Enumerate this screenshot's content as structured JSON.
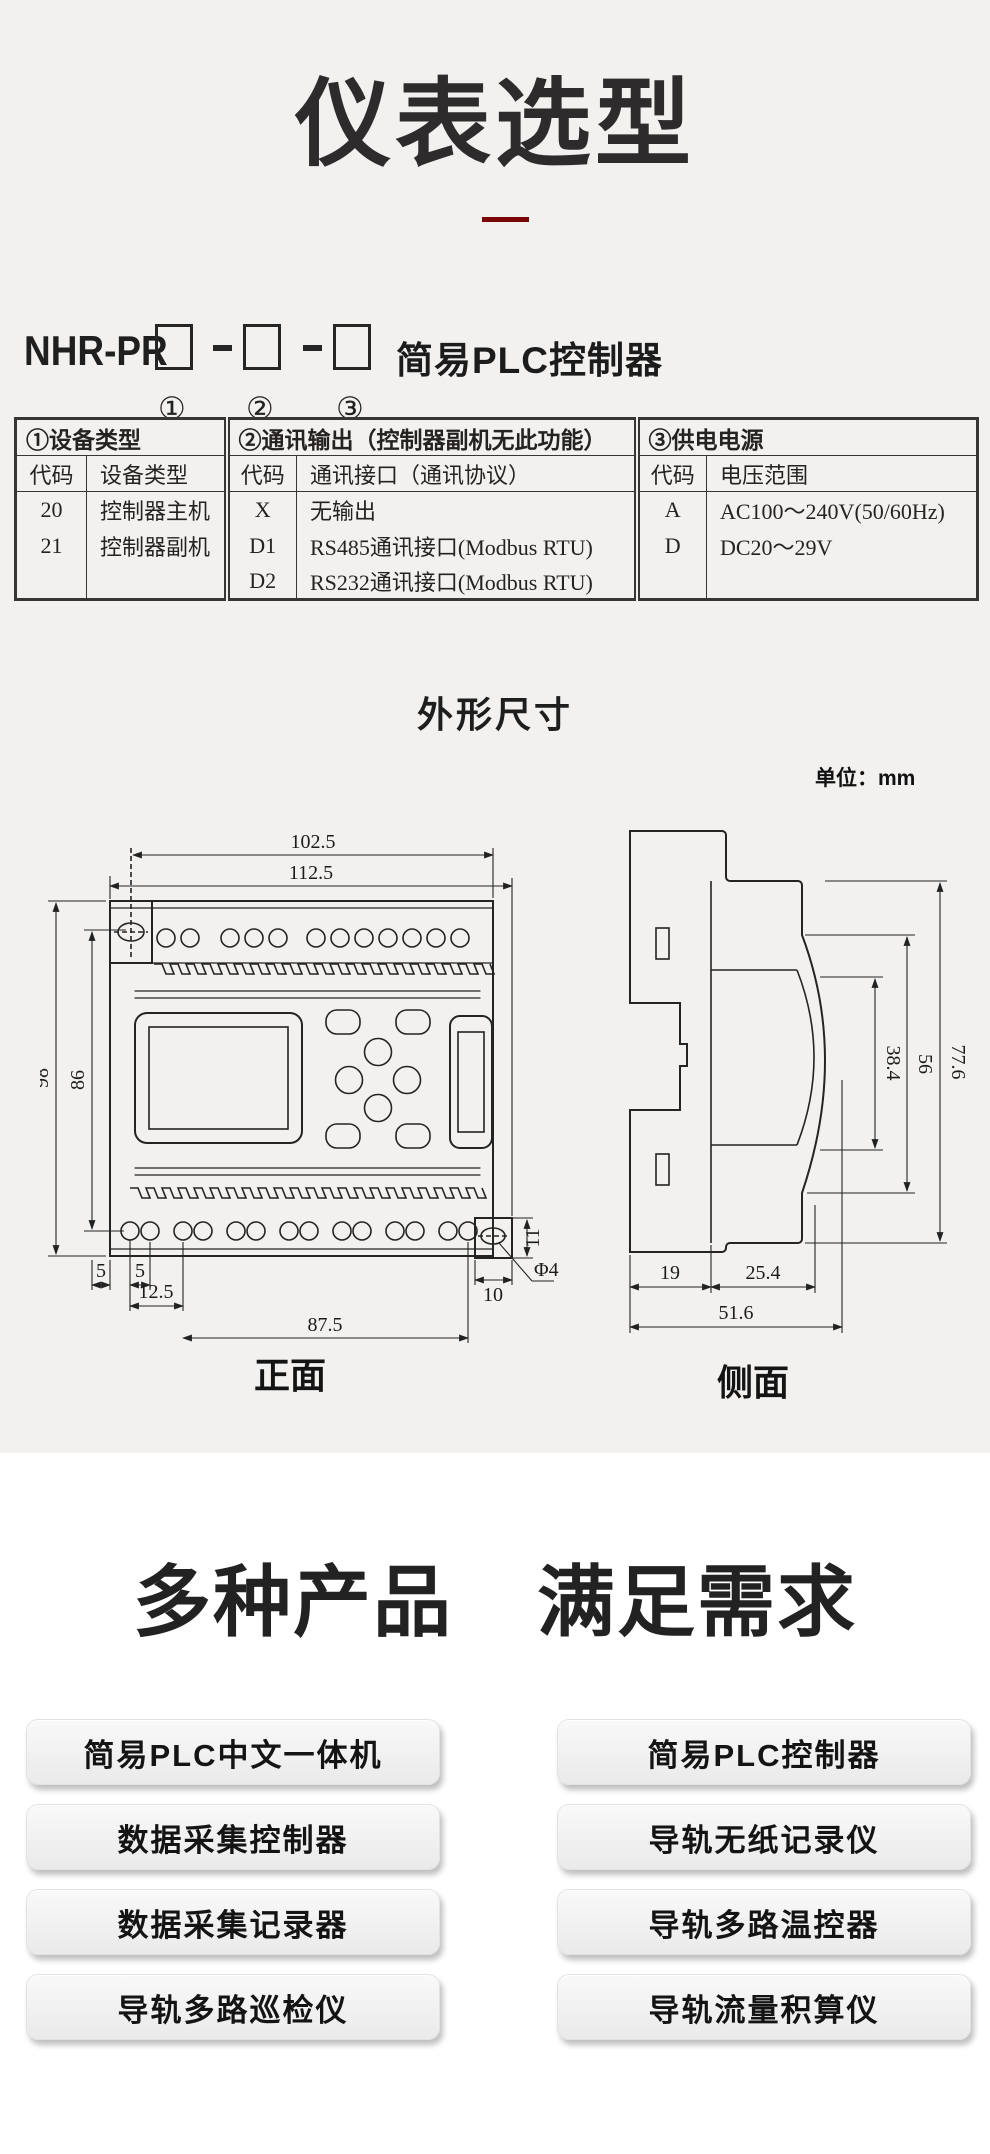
{
  "title": "仪表选型",
  "model": {
    "prefix": "NHR-PR",
    "suffix": "简易PLC控制器",
    "marks": [
      "①",
      "②",
      "③"
    ]
  },
  "table": {
    "sections": [
      "①设备类型",
      "②通讯输出（控制器副机无此功能）",
      "③供电电源"
    ],
    "columns": [
      "代码",
      "设备类型",
      "代码",
      "通讯接口（通讯协议）",
      "代码",
      "电压范围"
    ],
    "rows": [
      [
        "20",
        "控制器主机",
        "X",
        "无输出",
        "A",
        "AC100～240V(50/60Hz)"
      ],
      [
        "21",
        "控制器副机",
        "D1",
        "RS485通讯接口(Modbus RTU)",
        "D",
        "DC20～29V"
      ],
      [
        "",
        "",
        "D2",
        "RS232通讯接口(Modbus RTU)",
        "",
        ""
      ]
    ]
  },
  "dims": {
    "heading": "外形尺寸",
    "unit": "单位：mm",
    "front": {
      "label": "正面",
      "w1": "102.5",
      "w2": "112.5",
      "h1": "98",
      "h2": "86",
      "g1": "5",
      "g2": "5",
      "g3": "12.5",
      "g4": "87.5",
      "e1": "11",
      "e2": "10",
      "hole": "Φ4"
    },
    "side": {
      "label": "侧面",
      "h1": "77.6",
      "h2": "56",
      "h3": "38.4",
      "d1": "19",
      "d2": "25.4",
      "d3": "51.6"
    }
  },
  "products": {
    "heading": [
      "多种产品",
      "满足需求"
    ],
    "items": [
      "简易PLC中文一体机",
      "简易PLC控制器",
      "数据采集控制器",
      "导轨无纸记录仪",
      "数据采集记录器",
      "导轨多路温控器",
      "导轨多路巡检仪",
      "导轨流量积算仪"
    ]
  },
  "colors": {
    "accent_red": "#7a0708",
    "page_gray": "#f2f1ef"
  }
}
